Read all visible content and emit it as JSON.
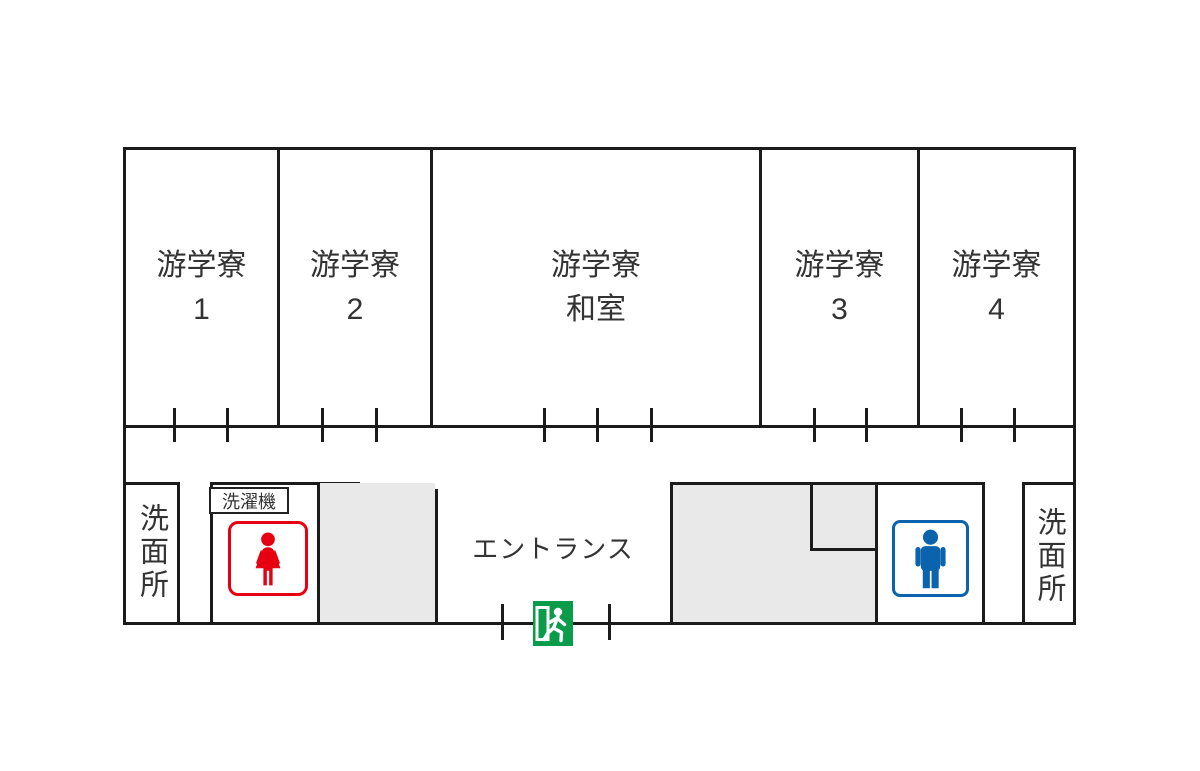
{
  "title": "dormitory-floor-plan",
  "rooms": {
    "room1": {
      "line1": "游学寮",
      "line2": "1"
    },
    "room2": {
      "line1": "游学寮",
      "line2": "2"
    },
    "washitsu": {
      "line1": "游学寮",
      "line2": "和室"
    },
    "room3": {
      "line1": "游学寮",
      "line2": "3"
    },
    "room4": {
      "line1": "游学寮",
      "line2": "4"
    }
  },
  "facilities": {
    "washroom_left": "洗面所",
    "washroom_right": "洗面所",
    "laundry": "洗濯機",
    "entrance": "エントランス"
  },
  "icons": {
    "womens_restroom": "womens-restroom-icon",
    "mens_restroom": "mens-restroom-icon",
    "emergency_exit": "emergency-exit-icon"
  },
  "colors": {
    "wall": "#1b1b1b",
    "text": "#333333",
    "room_fill": "#ffffff",
    "gray_fill": "#e9e9e9",
    "restroom_red": "#e60012",
    "restroom_blue": "#0b62ad",
    "exit_green": "#0a9b4b"
  }
}
